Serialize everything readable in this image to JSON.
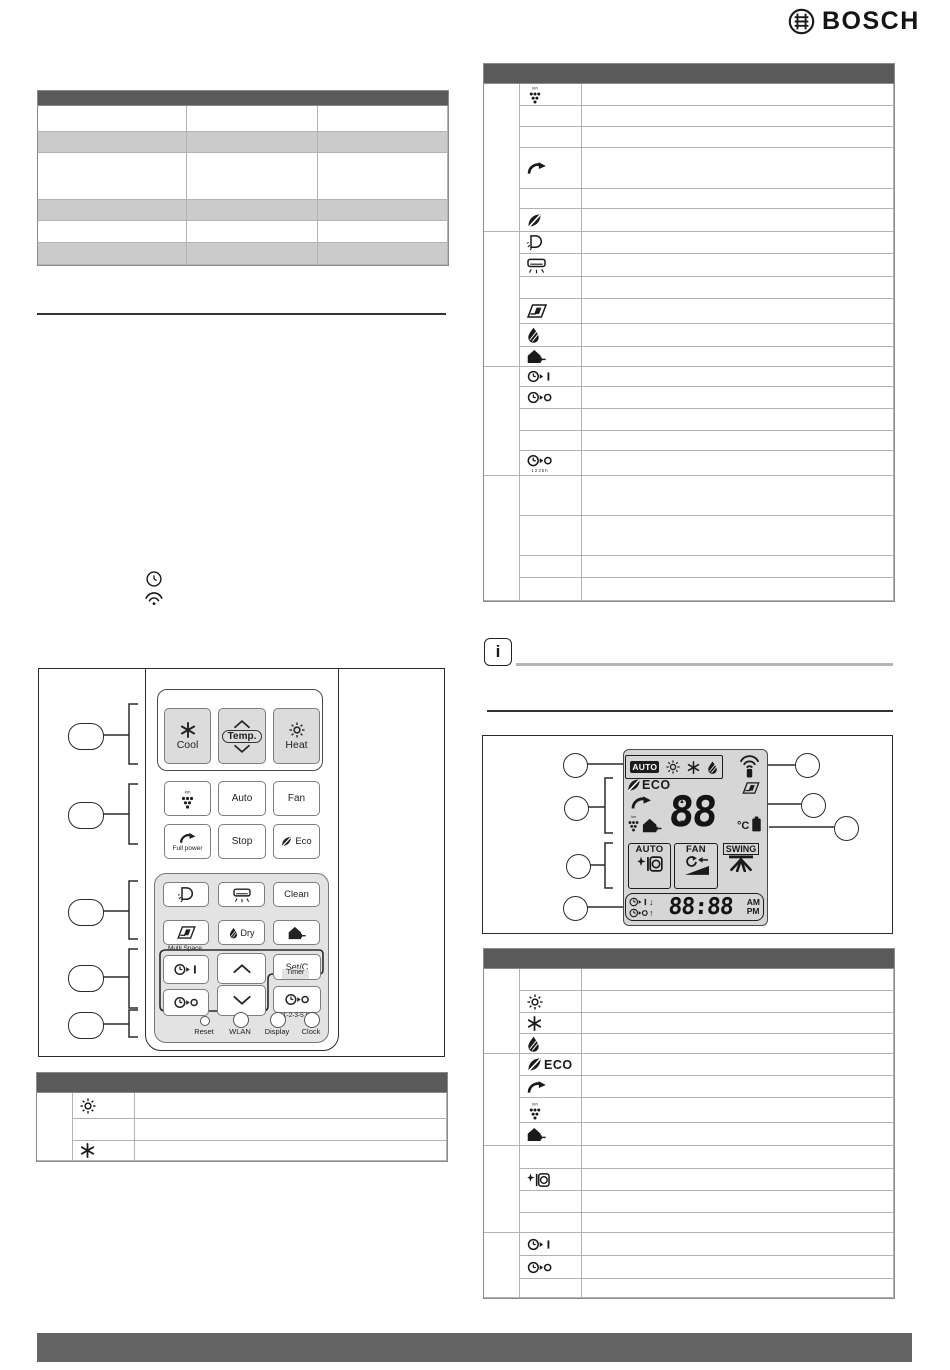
{
  "brand": {
    "logo_text": "BOSCH",
    "symbol": "bosch-armature-icon"
  },
  "left_notes": {
    "clock_icon": "clock-icon",
    "wifi_icon": "wifi-icon"
  },
  "info_note": {
    "icon_label": "i"
  },
  "remote": {
    "mode_buttons": {
      "cool": "Cool",
      "temp": "Temp.",
      "heat": "Heat"
    },
    "row2": {
      "auto": "Auto",
      "fan": "Fan"
    },
    "row3": {
      "full_power": "Full power",
      "stop": "Stop",
      "eco": "Eco"
    },
    "panel": {
      "clean": "Clean",
      "dry": "Dry",
      "multi_space": "Multi Space",
      "set": "Set/C",
      "timer_label": "Timer",
      "timer_hours": "1-2-3-5 h"
    },
    "bottom": {
      "reset": "Reset",
      "wlan": "WLAN",
      "display": "Display",
      "clock": "Clock"
    }
  },
  "lcd": {
    "mode_auto": "AUTO",
    "eco": "ECO",
    "temp_value": "88",
    "temp_unit": "°C",
    "up_mark": "▲",
    "down_mark": "▼",
    "fan_auto_box": "AUTO",
    "fan_box": "FAN",
    "swing_box": "SWING",
    "time_value": "88:88",
    "am": "AM",
    "pm": "PM",
    "timer_down_arrow": "↓",
    "timer_up_arrow": "↑"
  },
  "tables": {
    "top_left": {
      "header": [
        "",
        "",
        ""
      ],
      "zebra": [
        0,
        1,
        0,
        1,
        0,
        1
      ],
      "rows": [
        [
          "",
          "",
          ""
        ],
        [
          "",
          "",
          ""
        ],
        [
          "",
          "",
          ""
        ],
        [
          "",
          "",
          ""
        ],
        [
          "",
          "",
          ""
        ],
        [
          "",
          "",
          ""
        ]
      ]
    },
    "top_right": {
      "header": [
        "",
        "",
        ""
      ],
      "sections": [
        {
          "rows": [
            {
              "icon": "ion",
              "text": ""
            },
            {
              "icon": null,
              "text": ""
            },
            {
              "icon": null,
              "text": ""
            },
            {
              "icon": "full-power",
              "text": ""
            },
            {
              "icon": null,
              "text": ""
            },
            {
              "icon": "eco-leaf",
              "text": ""
            }
          ]
        },
        {
          "rows": [
            {
              "icon": "self-clean",
              "text": ""
            },
            {
              "icon": "indoor-display",
              "text": ""
            },
            {
              "icon": null,
              "text": ""
            },
            {
              "icon": "louver",
              "text": ""
            },
            {
              "icon": "dry-drop",
              "text": ""
            },
            {
              "icon": "home-leave",
              "text": ""
            }
          ]
        },
        {
          "rows": [
            {
              "icon": "timer-on",
              "text": ""
            },
            {
              "icon": "timer-off",
              "text": ""
            },
            {
              "icon": null,
              "text": ""
            },
            {
              "icon": null,
              "text": ""
            },
            {
              "icon": "timer-1235",
              "text": ""
            }
          ]
        },
        {
          "rows": [
            {
              "icon": null,
              "text": ""
            },
            {
              "icon": null,
              "text": ""
            },
            {
              "icon": null,
              "text": ""
            },
            {
              "icon": null,
              "text": ""
            }
          ]
        }
      ]
    },
    "bottom_left": {
      "header": [
        "",
        "",
        ""
      ],
      "sections": [
        {
          "rows": [
            {
              "icon": "sun",
              "text": ""
            },
            {
              "icon": null,
              "text": ""
            },
            {
              "icon": "snowflake",
              "text": ""
            }
          ]
        }
      ]
    },
    "bottom_right": {
      "header": [
        "",
        "",
        ""
      ],
      "sections": [
        {
          "rows": [
            {
              "icon": null,
              "text": ""
            },
            {
              "icon": "sun",
              "text": ""
            },
            {
              "icon": "snowflake",
              "text": ""
            },
            {
              "icon": "dry-drop",
              "text": ""
            }
          ]
        },
        {
          "rows": [
            {
              "icon": "eco-leaf",
              "label": "ECO",
              "text": ""
            },
            {
              "icon": "full-power",
              "text": ""
            },
            {
              "icon": "ion",
              "text": ""
            },
            {
              "icon": "home-leave",
              "text": ""
            }
          ]
        },
        {
          "rows": [
            {
              "icon": null,
              "text": ""
            },
            {
              "icon": "clean-action",
              "text": ""
            },
            {
              "icon": null,
              "text": ""
            },
            {
              "icon": null,
              "text": ""
            }
          ]
        },
        {
          "rows": [
            {
              "icon": "timer-on",
              "text": ""
            },
            {
              "icon": "timer-off",
              "text": ""
            },
            {
              "icon": null,
              "text": ""
            }
          ]
        }
      ]
    }
  }
}
